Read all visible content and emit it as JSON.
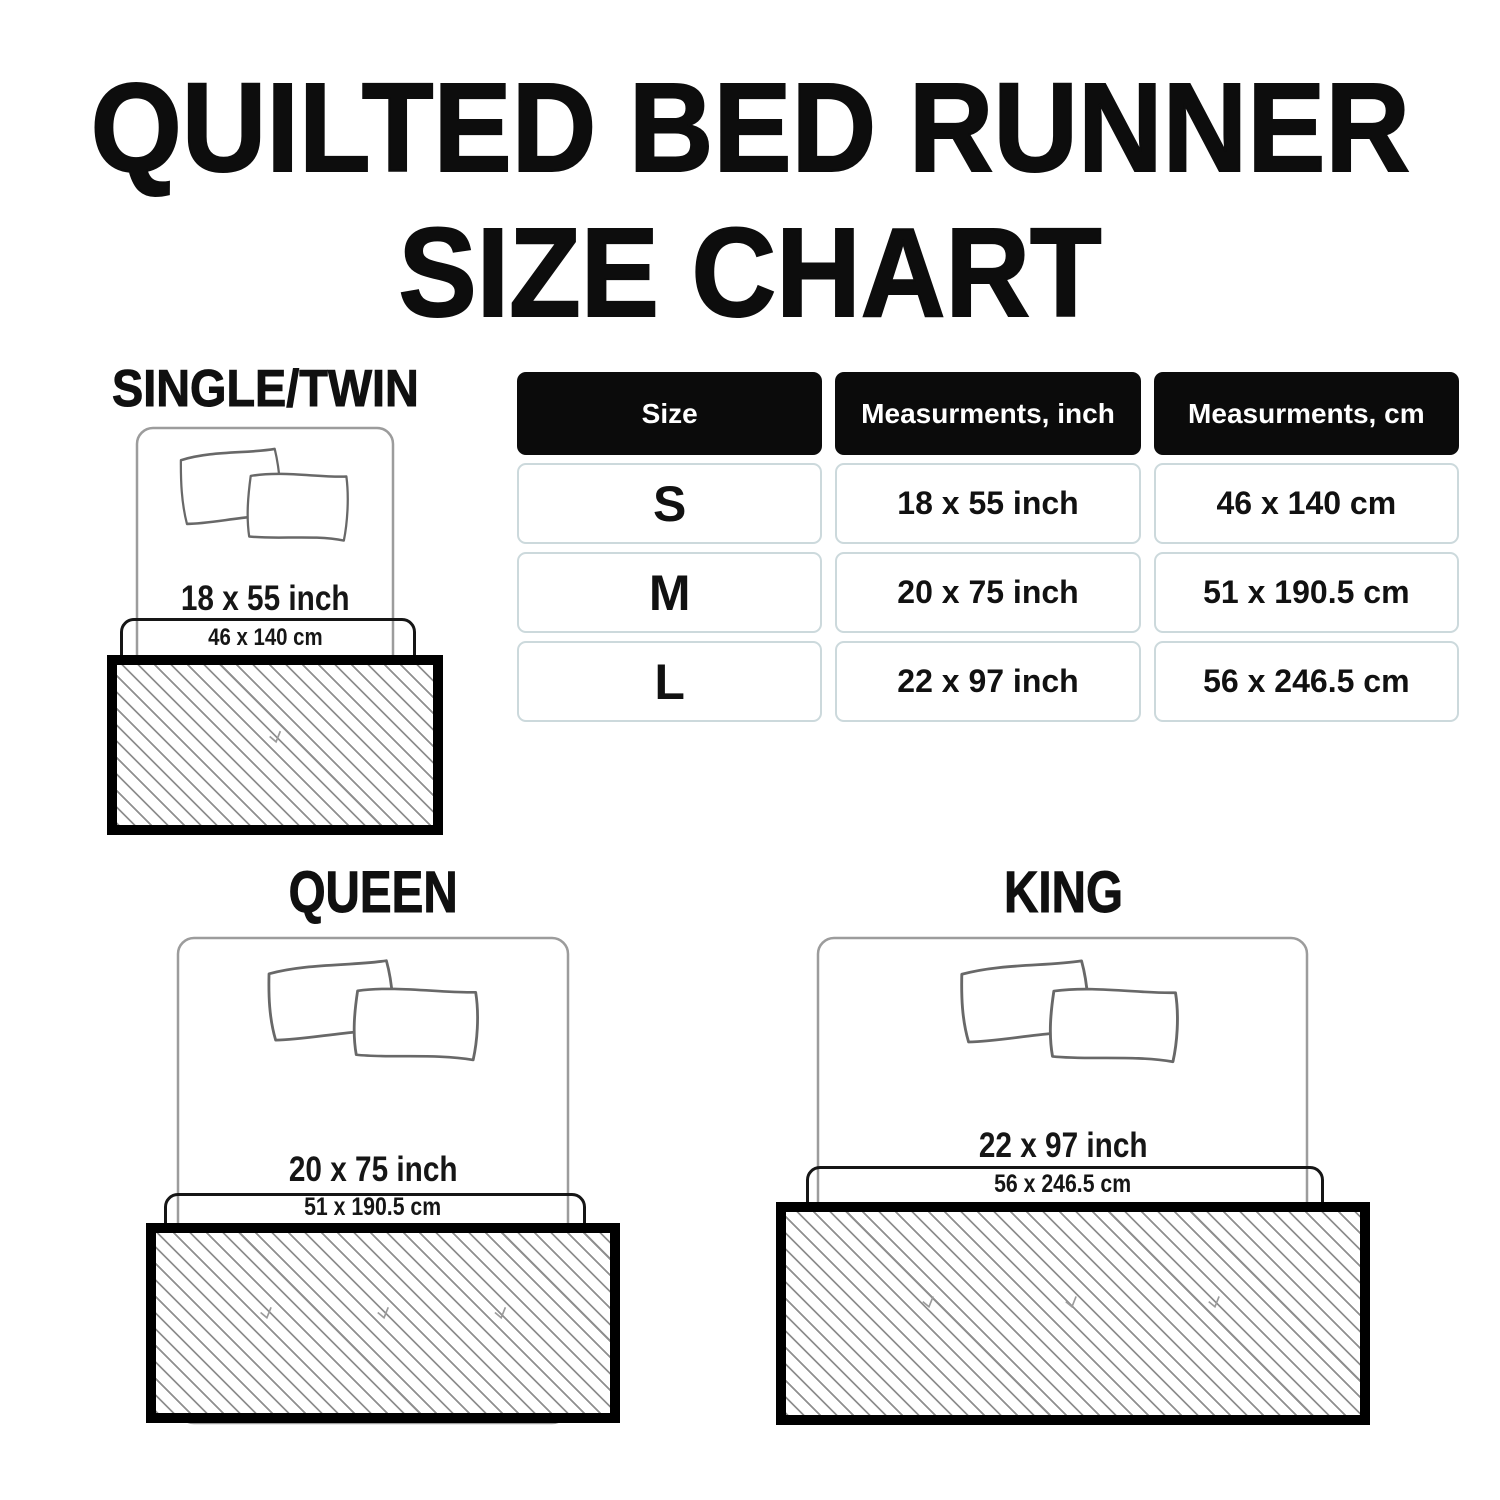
{
  "title": {
    "line1": "QUILTED BED RUNNER",
    "line2": "SIZE CHART"
  },
  "table": {
    "headers": [
      "Size",
      "Measurments, inch",
      "Measurments, cm"
    ],
    "rows": [
      {
        "size": "S",
        "inch": "18 x 55 inch",
        "cm": "46 x 140 cm"
      },
      {
        "size": "M",
        "inch": "20 x 75 inch",
        "cm": "51 x 190.5 cm"
      },
      {
        "size": "L",
        "inch": "22 x 97 inch",
        "cm": "56 x 246.5 cm"
      }
    ]
  },
  "diagrams": [
    {
      "label": "SINGLE/TWIN",
      "inch": "18 x 55 inch",
      "cm": "46 x 140 cm"
    },
    {
      "label": "QUEEN",
      "inch": "20 x 75 inch",
      "cm": "51 x 190.5 cm"
    },
    {
      "label": "KING",
      "inch": "22 x 97 inch",
      "cm": "56 x 246.5 cm"
    }
  ],
  "colors": {
    "header_bg": "#0b0b0b",
    "header_text": "#ffffff",
    "cell_border": "#ccd9dc",
    "hatch_line": "#8f8f8f",
    "runner_border": "#000000",
    "bed_outline": "#9c9c9c",
    "text": "#111111"
  }
}
